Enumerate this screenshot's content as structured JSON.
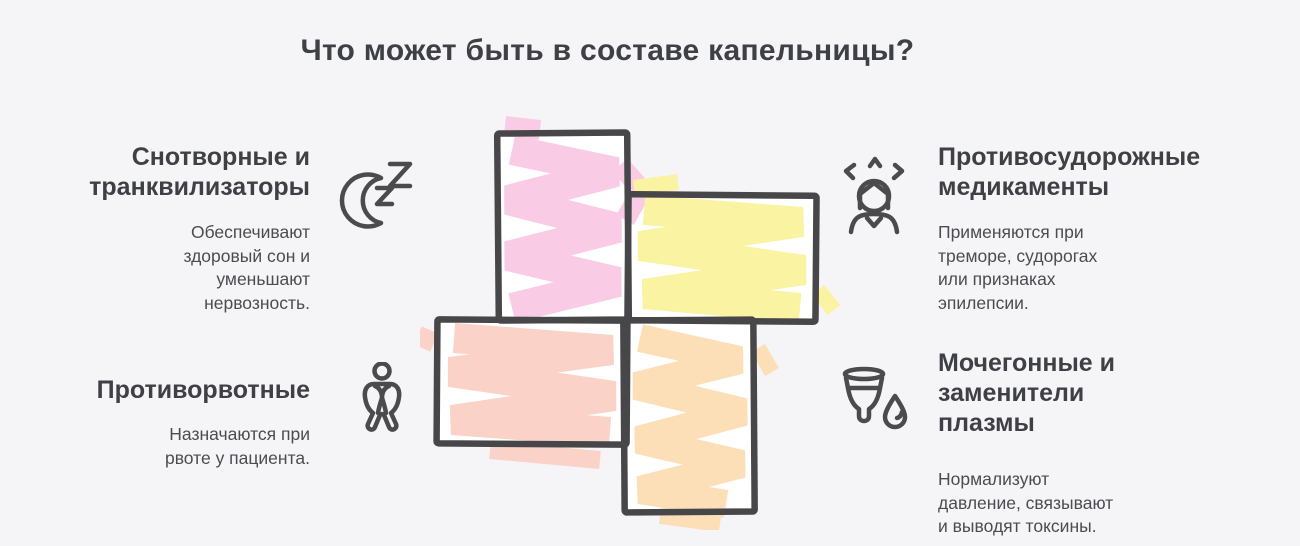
{
  "page": {
    "title": "Что может быть в составе капельницы?",
    "background": "#f5f5f8"
  },
  "sections": [
    {
      "id": "sleep-tranquilizers",
      "icon": "moon-zzz-icon",
      "title": "Снотворные и\nтранквилизаторы",
      "description": "Обеспечивают\nздоровый сон и\nуменьшают\nнервозность."
    },
    {
      "id": "anticonvulsants",
      "icon": "stressed-person-icon",
      "title": "Противосудорожные\nмедикаменты",
      "description": "Применяются при\nтреморе, судорогах\nили признаках\nэпилепсии."
    },
    {
      "id": "antiemetics",
      "icon": "nauseous-person-icon",
      "title": "Противорвотные",
      "description": "Назначаются при\nрвоте у пациента."
    },
    {
      "id": "diuretics-plasma",
      "icon": "cup-drop-icon",
      "title": "Мочегонные и\nзаменители\nплазмы",
      "description": "Нормализуют\nдавление, связывают\nи выводят токсины."
    }
  ],
  "figure": {
    "shape": "four-patch-pinwheel-cross",
    "outline_color": "#47474a",
    "colors": {
      "top_patch": "#f9cbe5",
      "right_patch": "#faf3a1",
      "left_patch": "#fbd2c7",
      "bottom_patch": "#fcdeb7"
    }
  }
}
